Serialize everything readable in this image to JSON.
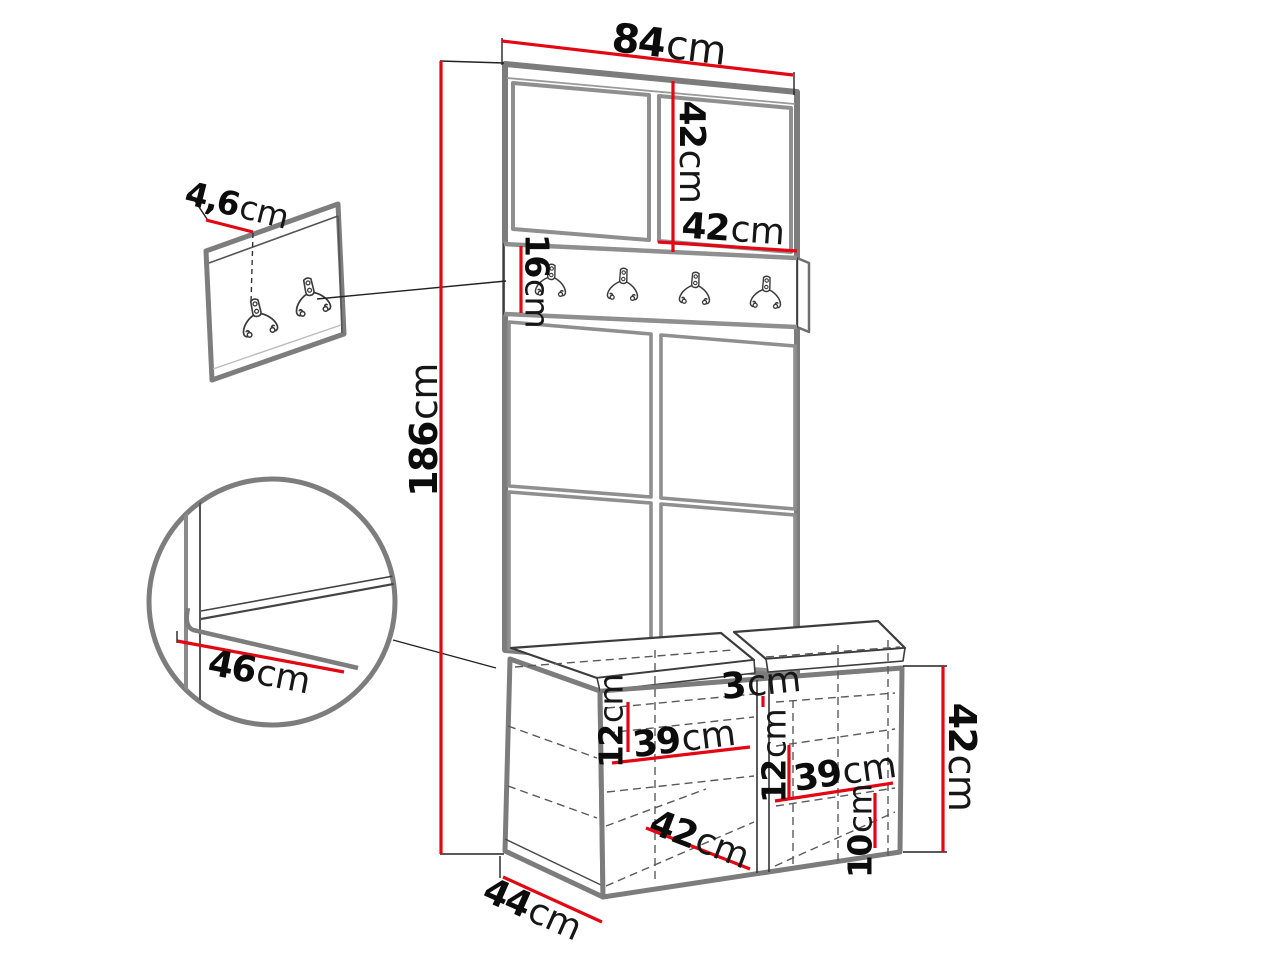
{
  "figure": {
    "type": "furniture-dimension-diagram",
    "description": "Hallway wardrobe set: tall upholstered panel unit with coat hook rail, storage bench with two compartments, separate wall hook panel and seat-corner detail circle",
    "measure_unit": "cm",
    "colors": {
      "dimension_red": "#e30613",
      "outline_gray": "#7d7d7d",
      "line_dark": "#2f2f2f",
      "background": "#ffffff"
    },
    "wall_panel": {
      "hook_count": 2
    },
    "hook_rail": {
      "hook_count": 4
    },
    "dimensions": [
      {
        "id": "top-width",
        "value": "84",
        "unit": "cm",
        "x": 669,
        "y": 45,
        "rotate": 7,
        "size": 40
      },
      {
        "id": "top-panel-height",
        "value": "42",
        "unit": "cm",
        "x": 691,
        "y": 152,
        "rotate": 90,
        "size": 36
      },
      {
        "id": "top-panel-width",
        "value": "42",
        "unit": "cm",
        "x": 733,
        "y": 230,
        "rotate": 4,
        "size": 36
      },
      {
        "id": "hook-rail-height",
        "value": "16",
        "unit": "cm",
        "x": 537,
        "y": 281,
        "rotate": 90,
        "size": 33
      },
      {
        "id": "total-height",
        "value": "186",
        "unit": "cm",
        "x": 424,
        "y": 430,
        "rotate": -90,
        "size": 38
      },
      {
        "id": "wall-panel-depth",
        "value": "4,6",
        "unit": "cm",
        "x": 237,
        "y": 205,
        "rotate": 14,
        "size": 33
      },
      {
        "id": "seat-depth-detail",
        "value": "46",
        "unit": "cm",
        "x": 259,
        "y": 673,
        "rotate": 11,
        "size": 36
      },
      {
        "id": "left-compartment-top-offset",
        "value": "12",
        "unit": "cm",
        "x": 611,
        "y": 721,
        "rotate": -90,
        "size": 33
      },
      {
        "id": "left-compartment-width",
        "value": "39",
        "unit": "cm",
        "x": 684,
        "y": 740,
        "rotate": -7,
        "size": 36
      },
      {
        "id": "seat-gap",
        "value": "3",
        "unit": "cm",
        "x": 761,
        "y": 684,
        "rotate": -6,
        "size": 36
      },
      {
        "id": "right-compartment-top-offset",
        "value": "12",
        "unit": "cm",
        "x": 774,
        "y": 756,
        "rotate": -90,
        "size": 33
      },
      {
        "id": "right-compartment-width",
        "value": "39",
        "unit": "cm",
        "x": 845,
        "y": 773,
        "rotate": -8,
        "size": 36
      },
      {
        "id": "bottom-shelf-height",
        "value": "10",
        "unit": "cm",
        "x": 860,
        "y": 831,
        "rotate": -90,
        "size": 33
      },
      {
        "id": "bench-height",
        "value": "42",
        "unit": "cm",
        "x": 962,
        "y": 757,
        "rotate": 90,
        "size": 38
      },
      {
        "id": "bench-inner-depth",
        "value": "42",
        "unit": "cm",
        "x": 699,
        "y": 840,
        "rotate": 21,
        "size": 36
      },
      {
        "id": "bench-depth",
        "value": "44",
        "unit": "cm",
        "x": 532,
        "y": 910,
        "rotate": 24,
        "size": 36
      }
    ]
  }
}
